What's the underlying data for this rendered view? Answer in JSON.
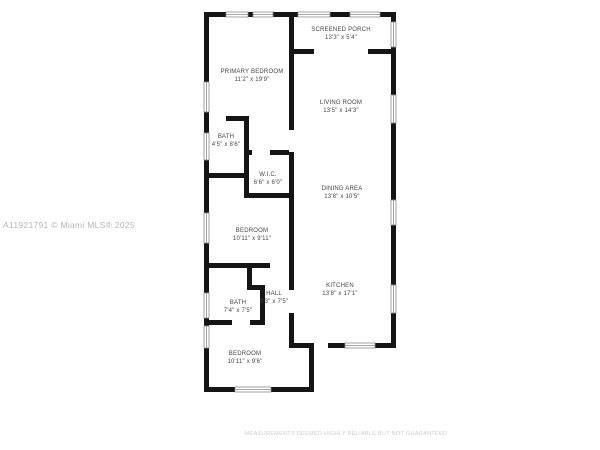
{
  "watermark": "A11921791 © Miami MLS® 2025",
  "disclaimer": "MEASUREMENTS DEEMED HIGHLY RELIABLE BUT NOT GUARANTEED",
  "rooms": {
    "screened_porch": {
      "name": "SCREENED PORCH",
      "dims": "13'3\" x 5'4\""
    },
    "primary_bedroom": {
      "name": "PRIMARY BEDROOM",
      "dims": "11'2\" x 19'9\""
    },
    "living_room": {
      "name": "LIVING ROOM",
      "dims": "13'5\" x 14'3\""
    },
    "bath_primary": {
      "name": "BATH",
      "dims": "4'5\" x 8'6\""
    },
    "wic": {
      "name": "W.I.C.",
      "dims": "6'6\" x 6'0\""
    },
    "dining_area": {
      "name": "DINING AREA",
      "dims": "13'8\" x 10'5\""
    },
    "bedroom_2": {
      "name": "BEDROOM",
      "dims": "10'11\" x 9'11\""
    },
    "kitchen": {
      "name": "KITCHEN",
      "dims": "13'8\" x 17'1\""
    },
    "bath_2": {
      "name": "BATH",
      "dims": "7'4\" x 7'5\""
    },
    "hall": {
      "name": "HALL",
      "dims": "3'3\" x 7'5\""
    },
    "bedroom_3": {
      "name": "BEDROOM",
      "dims": "10'11\" x 9'6\""
    }
  },
  "colors": {
    "wall": "#151515",
    "label": "#454545",
    "watermark": "#b5b5b5",
    "disclaimer": "#cccccc",
    "window_frame": "#8c8c8c"
  }
}
